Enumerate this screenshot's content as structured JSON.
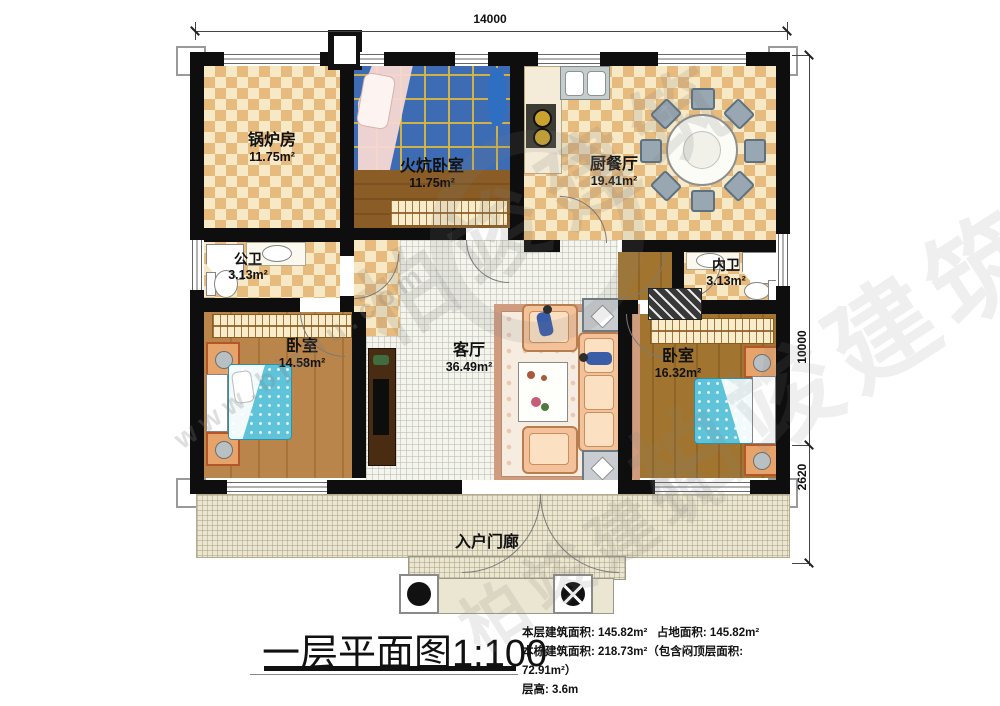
{
  "title": {
    "text": "一层平面图",
    "scale": "1:100"
  },
  "info": {
    "floor_area_label": "本层建筑面积:",
    "floor_area": "145.82m²",
    "land_area_label": "占地面积:",
    "land_area": "145.82m²",
    "building_area_label": "本栋建筑面积:",
    "building_area": "218.73m²",
    "attic_note": "（包含闷顶层面积: 72.91m²）",
    "height_label": "层高:",
    "height": "3.6m"
  },
  "dimensions": {
    "width_mm": "14000",
    "depth_mm": "10000",
    "porch_depth_mm": "2620"
  },
  "rooms": {
    "boiler": {
      "name": "锅炉房",
      "area": "11.75m²"
    },
    "kang_bedroom": {
      "name": "火炕卧室",
      "area": "11.75m²"
    },
    "kitchen_dining": {
      "name": "厨餐厅",
      "area": "19.41m²"
    },
    "public_bath": {
      "name": "公卫",
      "area": "3.13m²"
    },
    "inner_bath": {
      "name": "内卫",
      "area": "3.13m²"
    },
    "bedroom_left": {
      "name": "卧室",
      "area": "14.58m²"
    },
    "living": {
      "name": "客厅",
      "area": "36.49m²"
    },
    "bedroom_right": {
      "name": "卧室",
      "area": "16.32m²"
    },
    "porch": {
      "name": "入户门廊"
    }
  },
  "watermark": {
    "brand": "柏竣建筑",
    "site": "www.bjzhu.com"
  }
}
